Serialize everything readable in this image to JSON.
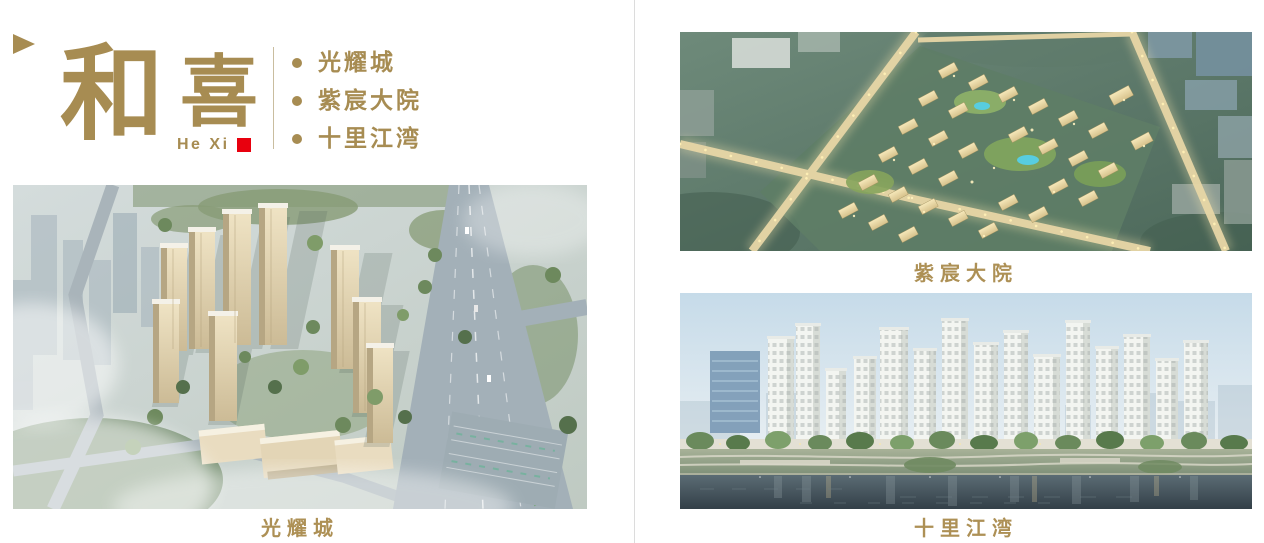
{
  "colors": {
    "gold": "#A78C52",
    "caption_gold": "#AD9055",
    "red_square": "#E8000E",
    "page_divider": "#DCDCDC",
    "brand_rule": "#C9BD9F"
  },
  "logo": {
    "char_primary": "和",
    "char_secondary": "喜",
    "romanized": "He Xi"
  },
  "icons": {
    "brand_triangle": "right-pointing-triangle",
    "list_bullet": "filled-circle"
  },
  "projects": {
    "items": [
      {
        "label": "光耀城"
      },
      {
        "label": "紫宸大院"
      },
      {
        "label": "十里江湾"
      }
    ]
  },
  "figures": {
    "guangyaocheng": {
      "caption": "光耀城"
    },
    "zichen": {
      "caption": "紫宸大院"
    },
    "shilijiangwan": {
      "caption": "十里江湾"
    }
  }
}
